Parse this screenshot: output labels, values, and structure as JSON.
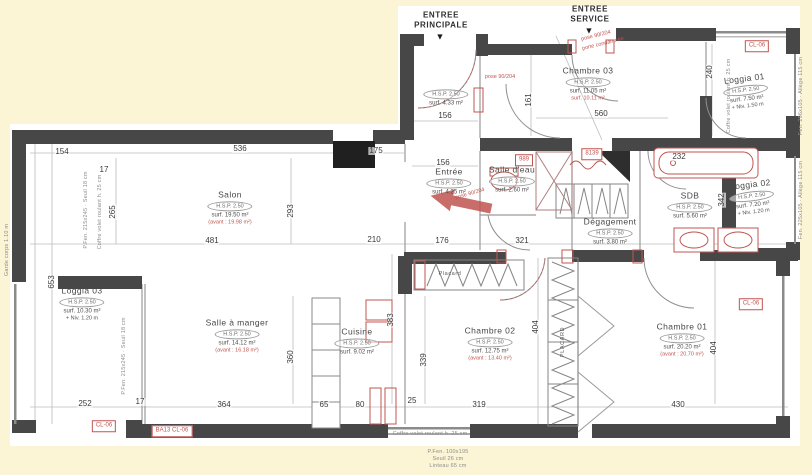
{
  "meta": {
    "paper": "#ffffff",
    "background": "#fbf5d6",
    "wall_color": "#474747",
    "annotation_red": "#bf5450"
  },
  "entrances": [
    {
      "label": "ENTREE\nPRINCIPALE",
      "marker": "▼",
      "x": 441,
      "y": 20,
      "mx": 440,
      "my": 37
    },
    {
      "label": "ENTREE\nSERVICE",
      "marker": "▼",
      "x": 590,
      "y": 14,
      "mx": 589,
      "my": 31
    }
  ],
  "rooms": [
    {
      "id": "salon",
      "name": "Salon",
      "hsp": "H.S.P. 2.50",
      "surf": "surf. 19.50 m²",
      "note": "(avant : 19.98 m²)",
      "noteRed": true,
      "x": 230,
      "y": 208,
      "rot": 0
    },
    {
      "id": "hall",
      "name": "",
      "hsp": "H.S.P. 2.50",
      "surf": "surf. 4.33 m²",
      "note": "",
      "noteRed": false,
      "x": 446,
      "y": 98,
      "rot": 0
    },
    {
      "id": "chambre-03",
      "name": "Chambre 03",
      "hsp": "H.S.P. 2.50",
      "surf": "surf. 11.05 m²",
      "note": "surf. 10.11 m²",
      "noteRed": true,
      "x": 588,
      "y": 84,
      "rot": 0
    },
    {
      "id": "entree",
      "name": "Entrée",
      "hsp": "H.S.P. 2.50",
      "surf": "surf. 4.25 m²",
      "note": "",
      "noteRed": false,
      "x": 449,
      "y": 182,
      "rot": 0
    },
    {
      "id": "salle-deau",
      "name": "Salle d'eau",
      "hsp": "H.S.P. 2.50",
      "surf": "surf. 2.60 m²",
      "note": "",
      "noteRed": false,
      "x": 512,
      "y": 180,
      "rot": 0
    },
    {
      "id": "degagement",
      "name": "Dégagement",
      "hsp": "H.S.P. 2.50",
      "surf": "surf. 3.80 m²",
      "note": "",
      "noteRed": false,
      "x": 610,
      "y": 232,
      "rot": 0
    },
    {
      "id": "sdb",
      "name": "SDB",
      "hsp": "H.S.P. 2.50",
      "surf": "surf. 5.60 m²",
      "note": "",
      "noteRed": false,
      "x": 690,
      "y": 206,
      "rot": 0
    },
    {
      "id": "loggia-01",
      "name": "Loggia 01",
      "hsp": "H.S.P. 2.50",
      "surf": "surf. 7.50 m²",
      "note": "+ Niv. 1.50 m",
      "noteRed": false,
      "x": 746,
      "y": 92,
      "rot": -7
    },
    {
      "id": "loggia-02",
      "name": "Loggia 02",
      "hsp": "H.S.P. 2.50",
      "surf": "surf. 7.20 m²",
      "note": "+ Niv. 1.20 m",
      "noteRed": false,
      "x": 752,
      "y": 198,
      "rot": -7
    },
    {
      "id": "loggia-03",
      "name": "Loggia 03",
      "hsp": "H.S.P. 2.50",
      "surf": "surf. 10.30 m²",
      "note": "+ Niv. 1.20 m",
      "noteRed": false,
      "x": 82,
      "y": 304,
      "rot": 0
    },
    {
      "id": "salle-a-manger",
      "name": "Salle à manger",
      "hsp": "H.S.P. 2.50",
      "surf": "surf. 14.12 m²",
      "note": "(avant : 16.18 m²)",
      "noteRed": true,
      "x": 237,
      "y": 336,
      "rot": 0
    },
    {
      "id": "cuisine",
      "name": "Cuisine",
      "hsp": "H.S.P. 2.50",
      "surf": "surf. 9.02 m²",
      "note": "",
      "noteRed": false,
      "x": 357,
      "y": 342,
      "rot": 0
    },
    {
      "id": "chambre-02",
      "name": "Chambre 02",
      "hsp": "H.S.P. 2.50",
      "surf": "surf. 12.75 m²",
      "note": "(avant : 13.40 m²)",
      "noteRed": true,
      "x": 490,
      "y": 344,
      "rot": 0
    },
    {
      "id": "chambre-01",
      "name": "Chambre 01",
      "hsp": "H.S.P. 2.50",
      "surf": "surf. 20.20 m²",
      "note": "(avant : 20.70 m²)",
      "noteRed": true,
      "x": 682,
      "y": 340,
      "rot": 0
    }
  ],
  "dims": [
    {
      "t": "154",
      "x": 62,
      "y": 152,
      "v": false
    },
    {
      "t": "536",
      "x": 240,
      "y": 149,
      "v": false
    },
    {
      "t": "175",
      "x": 376,
      "y": 151,
      "v": false
    },
    {
      "t": "17",
      "x": 104,
      "y": 170,
      "v": false
    },
    {
      "t": "156",
      "x": 445,
      "y": 116,
      "v": false
    },
    {
      "t": "156",
      "x": 443,
      "y": 163,
      "v": false
    },
    {
      "t": "161",
      "x": 529,
      "y": 100,
      "v": true
    },
    {
      "t": "560",
      "x": 601,
      "y": 114,
      "v": false
    },
    {
      "t": "240",
      "x": 710,
      "y": 72,
      "v": true
    },
    {
      "t": "232",
      "x": 679,
      "y": 157,
      "v": false
    },
    {
      "t": "342",
      "x": 722,
      "y": 200,
      "v": true
    },
    {
      "t": "265",
      "x": 113,
      "y": 212,
      "v": true
    },
    {
      "t": "481",
      "x": 212,
      "y": 241,
      "v": false
    },
    {
      "t": "293",
      "x": 291,
      "y": 211,
      "v": true
    },
    {
      "t": "210",
      "x": 374,
      "y": 240,
      "v": false
    },
    {
      "t": "176",
      "x": 442,
      "y": 241,
      "v": false
    },
    {
      "t": "321",
      "x": 522,
      "y": 241,
      "v": false
    },
    {
      "t": "653",
      "x": 52,
      "y": 282,
      "v": true
    },
    {
      "t": "360",
      "x": 291,
      "y": 357,
      "v": true
    },
    {
      "t": "383",
      "x": 391,
      "y": 320,
      "v": true
    },
    {
      "t": "339",
      "x": 424,
      "y": 360,
      "v": true
    },
    {
      "t": "404",
      "x": 536,
      "y": 327,
      "v": true
    },
    {
      "t": "404",
      "x": 714,
      "y": 348,
      "v": true
    },
    {
      "t": "252",
      "x": 85,
      "y": 404,
      "v": false
    },
    {
      "t": "17",
      "x": 140,
      "y": 402,
      "v": false
    },
    {
      "t": "364",
      "x": 224,
      "y": 405,
      "v": false
    },
    {
      "t": "65",
      "x": 324,
      "y": 405,
      "v": false
    },
    {
      "t": "80",
      "x": 360,
      "y": 405,
      "v": false
    },
    {
      "t": "25",
      "x": 412,
      "y": 401,
      "v": false
    },
    {
      "t": "319",
      "x": 479,
      "y": 405,
      "v": false
    },
    {
      "t": "430",
      "x": 678,
      "y": 405,
      "v": false
    }
  ],
  "tags": [
    {
      "t": "989",
      "x": 524,
      "y": 160
    },
    {
      "t": "8139",
      "x": 592,
      "y": 154
    },
    {
      "t": "CL-06",
      "x": 757,
      "y": 46
    },
    {
      "t": "CL-06",
      "x": 751,
      "y": 304
    },
    {
      "t": "CL-06",
      "x": 104,
      "y": 426
    },
    {
      "t": "BA13 CL-06",
      "x": 172,
      "y": 431
    }
  ],
  "red_notes": [
    {
      "t": "pose 90/204",
      "x": 500,
      "y": 77,
      "rot": 0
    },
    {
      "t": "pose 90/204",
      "x": 596,
      "y": 36,
      "rot": -14
    },
    {
      "t": "porte condamnée",
      "x": 603,
      "y": 44,
      "rot": -14
    },
    {
      "t": "pose 90/204",
      "x": 470,
      "y": 194,
      "rot": -16
    }
  ],
  "side_notes": [
    {
      "t": "Fen. 296x105 · Allège 115 cm",
      "x": 801,
      "y": 96,
      "rot": -90
    },
    {
      "t": "Fen. 225x105 · Allège 115 cm",
      "x": 801,
      "y": 200,
      "rot": -90
    },
    {
      "t": "Coffre volet roulant h. 25 cm",
      "x": 729,
      "y": 96,
      "rot": -90
    },
    {
      "t": "P.Fen. 215x245 · Seuil 18 cm",
      "x": 86,
      "y": 210,
      "rot": -90
    },
    {
      "t": "Coffre volet roulant h. 25 cm",
      "x": 100,
      "y": 212,
      "rot": -90
    },
    {
      "t": "P.Fen. 215x245 · Seuil 18 cm",
      "x": 124,
      "y": 356,
      "rot": -90
    },
    {
      "t": "Garde corps 1.10 m",
      "x": 7,
      "y": 250,
      "rot": -90
    },
    {
      "t": "Coffre volet roulant h. 25 cm",
      "x": 430,
      "y": 434,
      "rot": 0
    },
    {
      "t": "P.Fen. 100x195",
      "x": 448,
      "y": 452,
      "rot": 0
    },
    {
      "t": "Seuil 26 cm",
      "x": 448,
      "y": 459,
      "rot": 0
    },
    {
      "t": "Linteau 65 cm",
      "x": 448,
      "y": 466,
      "rot": 0
    }
  ],
  "fixtures": [
    {
      "t": "Placard",
      "x": 450,
      "y": 274,
      "rot": 0
    },
    {
      "t": "PLACARD",
      "x": 563,
      "y": 342,
      "rot": -90
    }
  ]
}
